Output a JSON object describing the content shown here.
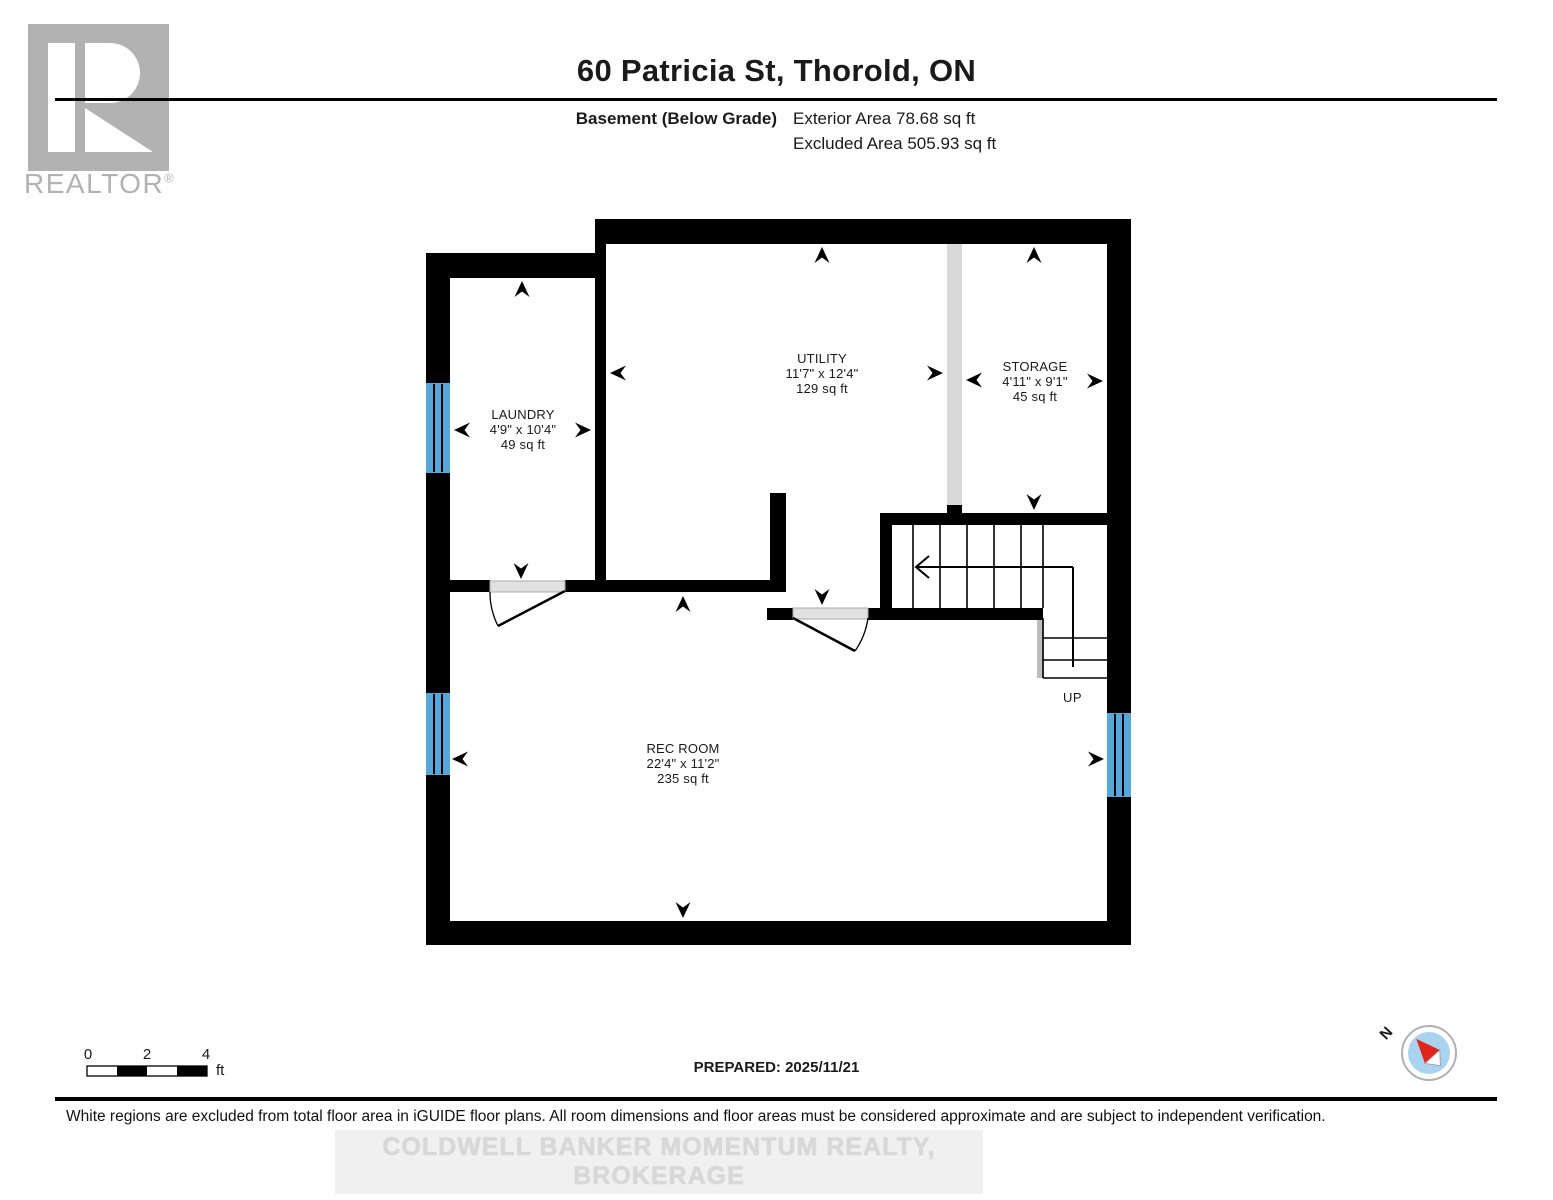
{
  "header": {
    "logo_text": "REALTOR",
    "logo_reg": "®",
    "title": "60 Patricia St, Thorold, ON",
    "floor_label": "Basement (Below Grade)",
    "exterior_area": "Exterior Area 78.68 sq ft",
    "excluded_area": "Excluded Area 505.93 sq ft"
  },
  "rooms": {
    "laundry": {
      "name": "LAUNDRY",
      "dims": "4'9\" x 10'4\"",
      "area": "49 sq ft"
    },
    "utility": {
      "name": "UTILITY",
      "dims": "11'7\" x 12'4\"",
      "area": "129 sq ft"
    },
    "storage": {
      "name": "STORAGE",
      "dims": "4'11\" x 9'1\"",
      "area": "45 sq ft"
    },
    "rec_room": {
      "name": "REC ROOM",
      "dims": "22'4\" x 11'2\"",
      "area": "235 sq ft"
    }
  },
  "stairs": {
    "up_label": "UP"
  },
  "scale_bar": {
    "ticks": [
      "0",
      "2",
      "4"
    ],
    "unit": "ft"
  },
  "footer": {
    "prepared": "PREPARED: 2025/11/21",
    "compass_north": "N",
    "disclaimer": "White regions are excluded from total floor area in iGUIDE floor plans. All room dimensions and floor areas must be considered approximate and are subject to independent verification.",
    "watermark": "COLDWELL BANKER MOMENTUM REALTY, BROKERAGE"
  },
  "colors": {
    "wall_black": "#000000",
    "window_blue": "#58a7d9",
    "chimney_grey": "#d9d9d9",
    "door_grey": "#e0e0e0",
    "logo_grey": "#b2b2b2",
    "compass_blue": "#a9d3ee",
    "compass_red": "#e1251b",
    "watermark_grey": "#d8d8d8"
  }
}
